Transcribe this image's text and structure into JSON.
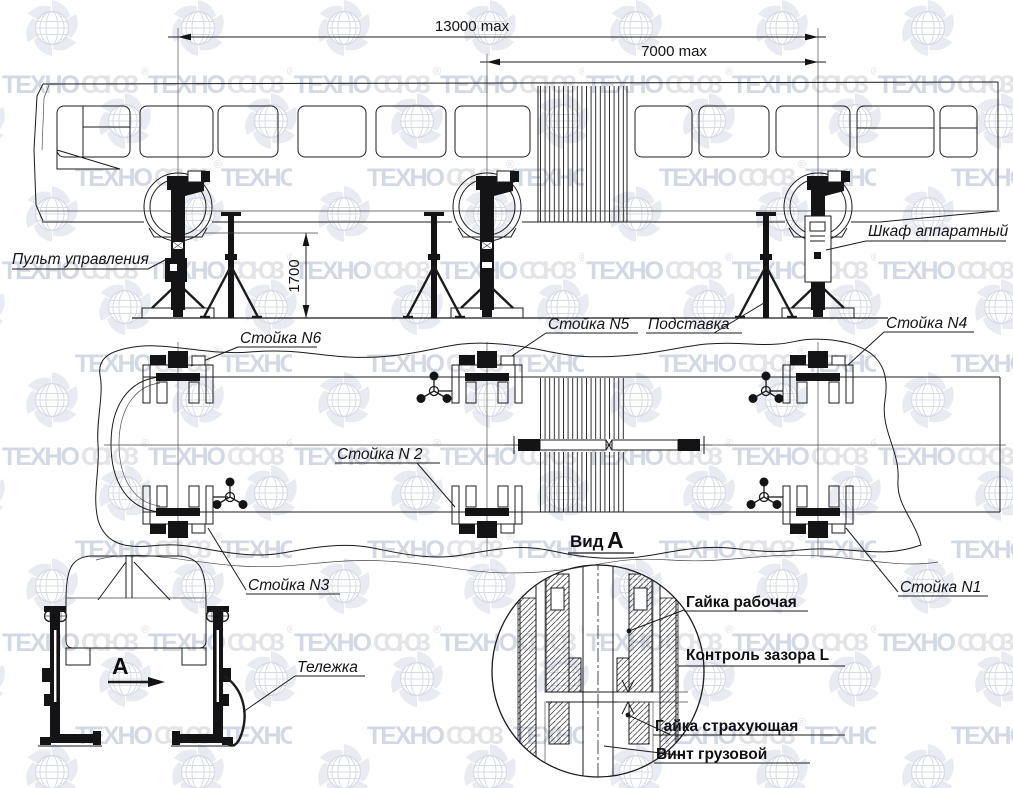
{
  "watermark": {
    "part1": "ТЕХНО",
    "part2": "СОЮЗ",
    "reg": "®"
  },
  "dimensions": {
    "overall": "13000 max",
    "partial": "7000 max",
    "height": "1700"
  },
  "labels": {
    "control_panel": "Пульт управления",
    "cabinet": "Шкаф аппаратный",
    "stand6": "Стойка N6",
    "stand5": "Стойка N5",
    "support": "Подставка",
    "stand4": "Стойка N4",
    "stand2": "Стойка N 2",
    "stand3": "Стойка N3",
    "stand1": "Стойка N1",
    "view_word": "Вид",
    "view_letter": "А",
    "arrow_letter": "А",
    "trolley": "Тележка",
    "working_nut": "Гайка рабочая",
    "gap_control": "Контроль зазора  L",
    "safety_nut": "Гайка страхующая",
    "load_screw": "Винт грузовой"
  }
}
